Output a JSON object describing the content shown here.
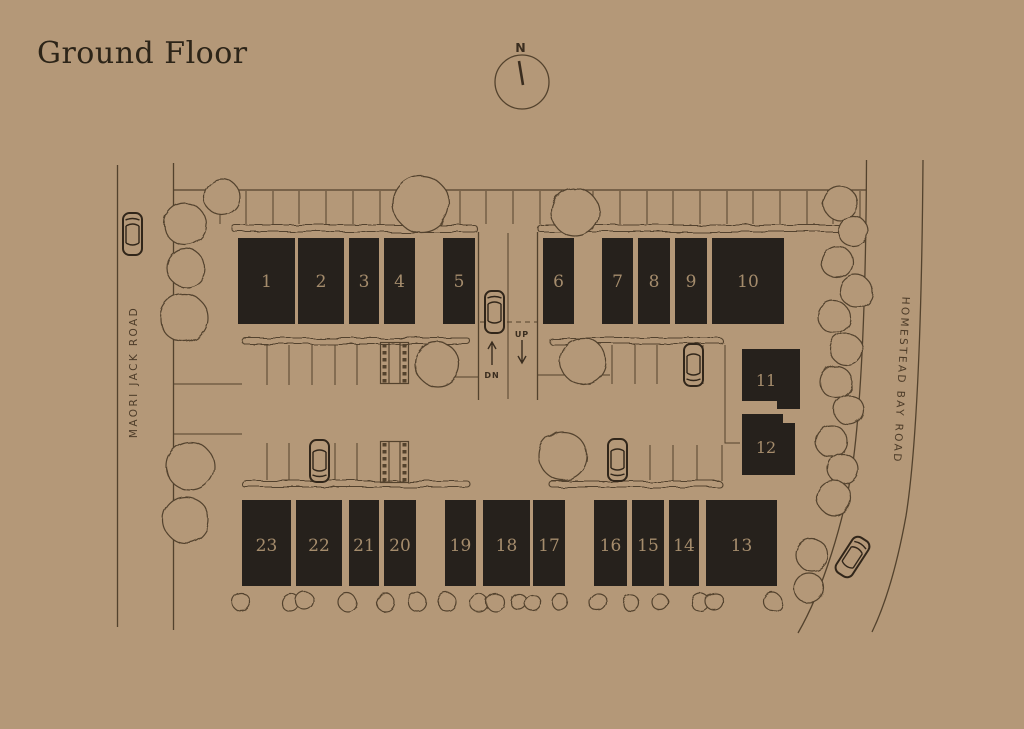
{
  "title": "Ground Floor",
  "compass": {
    "label": "N"
  },
  "roads": {
    "left_label": "MAORI JACK ROAD",
    "right_label": "HOMESTEAD BAY ROAD"
  },
  "ramp": {
    "up_label": "UP",
    "down_label": "DN"
  },
  "units": {
    "top_row": [
      "1",
      "2",
      "3",
      "4",
      "5",
      "6",
      "7",
      "8",
      "9",
      "10"
    ],
    "right_column": [
      "11",
      "12"
    ],
    "bottom_row": [
      "23",
      "22",
      "21",
      "20",
      "19",
      "18",
      "17",
      "16",
      "15",
      "14",
      "13"
    ]
  },
  "colors": {
    "background": "#b49878",
    "line_ink": "#53422d",
    "unit_block": "#26211c",
    "unit_number": "#a58c6c",
    "title_text": "#2c2418"
  }
}
